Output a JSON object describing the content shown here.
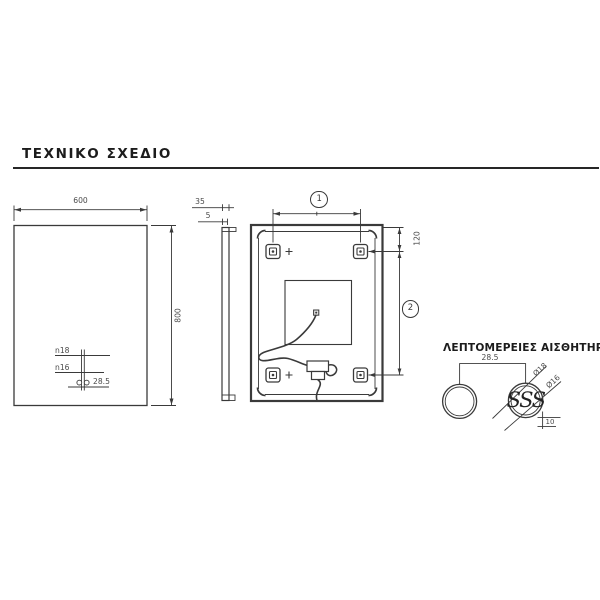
{
  "header": {
    "title": "ΤΕΧΝΙΚΟ ΣΧΕΔΙΟ"
  },
  "front_view": {
    "width": "600",
    "height": "800",
    "hole_large": "n18",
    "hole_small": "n16",
    "hole_offset": "28.5"
  },
  "side_view": {
    "depth": "35",
    "glass": "5"
  },
  "back_view": {
    "callout_top": "1",
    "callout_side": "2",
    "bracket_offset": "120"
  },
  "details": {
    "title": "ΛΕΠΤΟΜΕΡΕΙΕΣ ΑΙΣΘΗΤΗΡΩΝ",
    "spacing": "28.5",
    "outer_dia": "Ø18",
    "inner_dia": "Ø16",
    "depth": "10",
    "symbol": "SSS"
  },
  "colors": {
    "background": "#ffffff",
    "line": "#3a3a3a",
    "text": "#4a4a4a",
    "title": "#1c1c1c"
  }
}
